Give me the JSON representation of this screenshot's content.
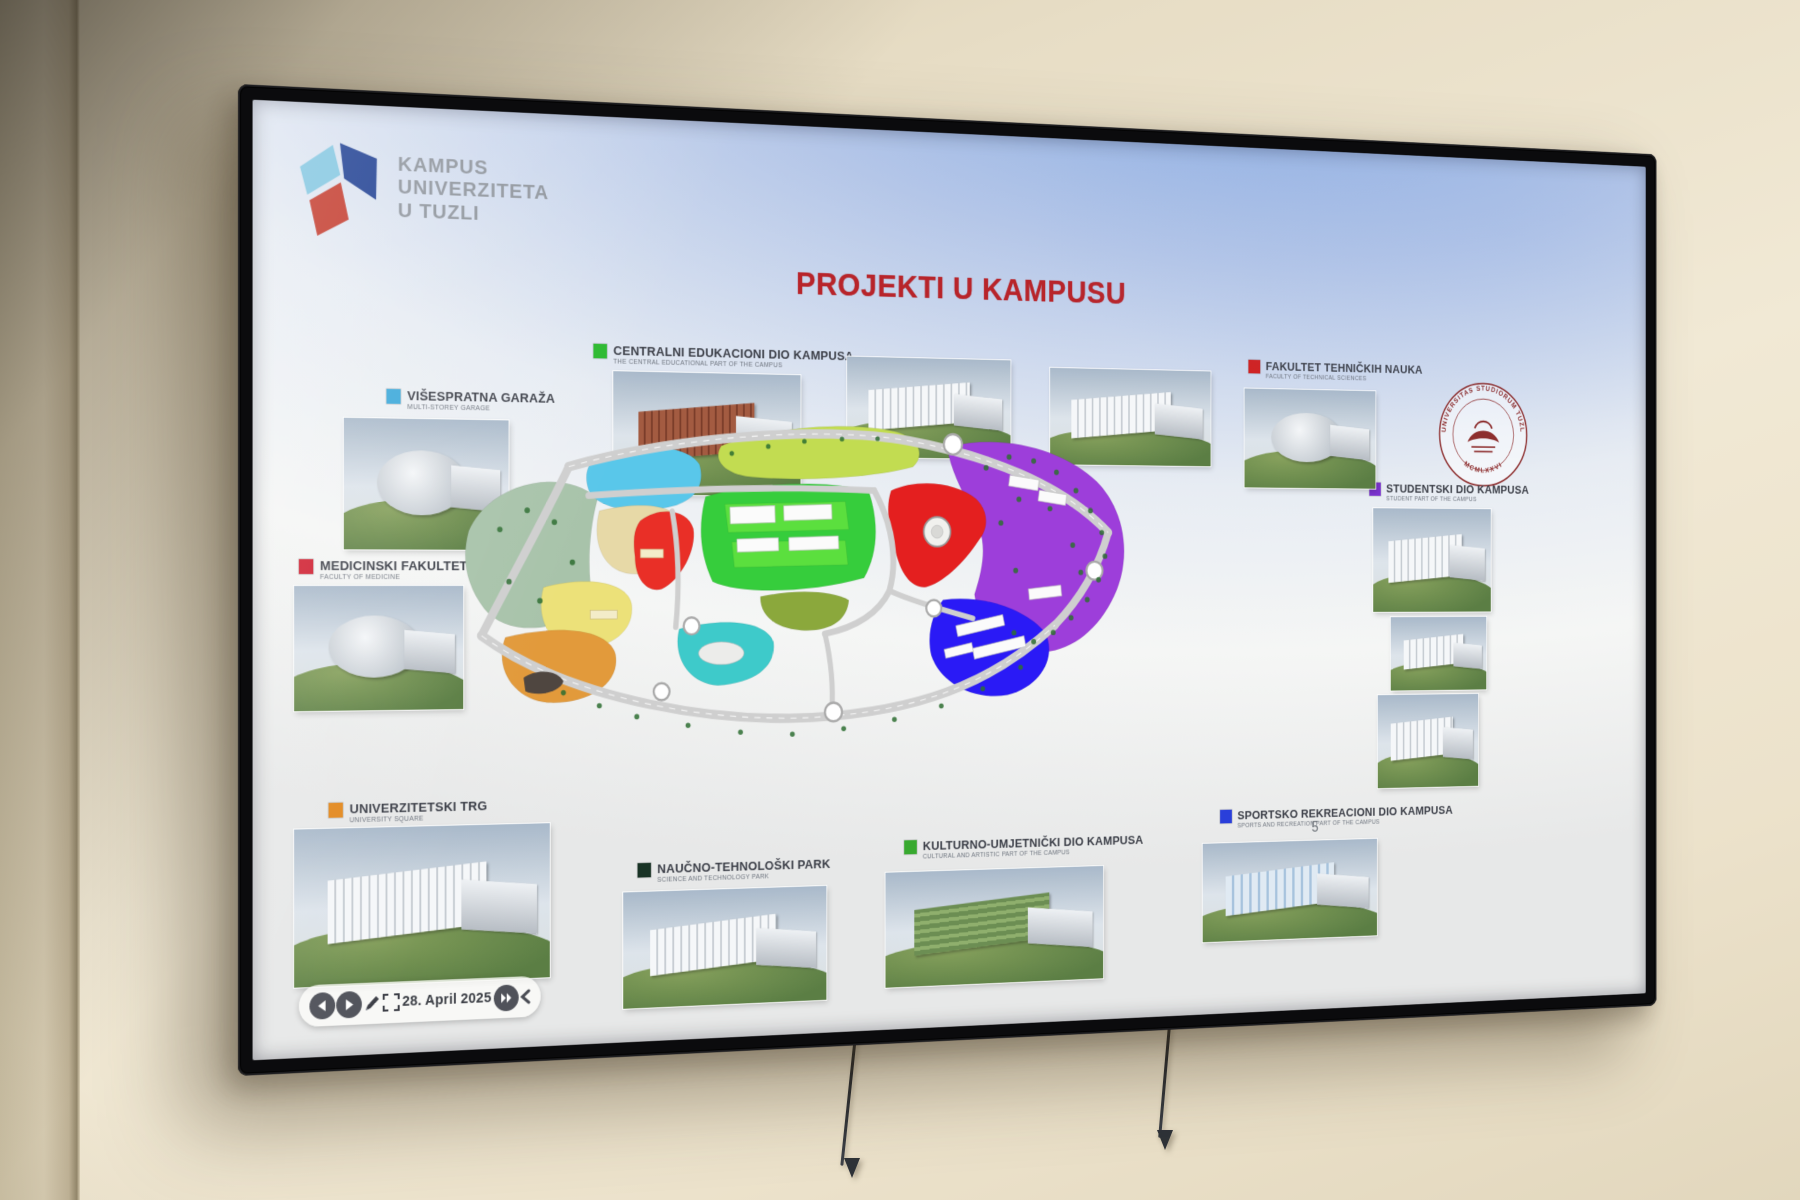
{
  "scene": {
    "wall_color": "#ece2cb",
    "tv_bezel_color": "#0b0b0d"
  },
  "slide": {
    "logo": {
      "lines": [
        "KAMPUS",
        "UNIVERZITETA",
        "U TUZLI"
      ],
      "cube_colors": {
        "top": "#84c6e0",
        "right": "#1d3d8f",
        "bottom": "#c03a2c"
      }
    },
    "title": {
      "text": "PROJEKTI U KAMPUSU",
      "color": "#b5252b"
    },
    "page_number": "5",
    "legend": [
      {
        "id": "garage",
        "label": "VIŠESPRATNA GARAŽA",
        "sublabel": "MULTI-STOREY GARAGE",
        "color": "#3fa8d8"
      },
      {
        "id": "central",
        "label": "CENTRALNI EDUKACIONI DIO KAMPUSA",
        "sublabel": "THE CENTRAL EDUCATIONAL PART OF THE CAMPUS",
        "color": "#2eb832"
      },
      {
        "id": "ftn",
        "label": "FAKULTET TEHNIČKIH NAUKA",
        "sublabel": "FACULTY OF TECHNICAL SCIENCES",
        "color": "#cc2222"
      },
      {
        "id": "student",
        "label": "STUDENTSKI DIO KAMPUSA",
        "sublabel": "STUDENT PART OF THE CAMPUS",
        "color": "#7b35cc"
      },
      {
        "id": "medical",
        "label": "MEDICINSKI FAKULTET",
        "sublabel": "FACULTY OF MEDICINE",
        "color": "#cc2233"
      },
      {
        "id": "square",
        "label": "UNIVERZITETSKI TRG",
        "sublabel": "UNIVERSITY SQUARE",
        "color": "#e08820"
      },
      {
        "id": "techpark",
        "label": "NAUČNO-TEHNOLOŠKI PARK",
        "sublabel": "SCIENCE AND TECHNOLOGY PARK",
        "color": "#1a3325"
      },
      {
        "id": "cultural",
        "label": "KULTURNO-UMJETNIČKI DIO KAMPUSA",
        "sublabel": "CULTURAL AND ARTISTIC PART OF THE CAMPUS",
        "color": "#3aa832"
      },
      {
        "id": "sports",
        "label": "SPORTSKO REKREACIONI DIO KAMPUSA",
        "sublabel": "SPORTS AND RECREATION PART OF THE CAMPUS",
        "color": "#2b3fd6"
      }
    ],
    "seal": {
      "ring_text": "UNIVERSITAS STUDIORUM TUZLAENSIS",
      "year_text": "MCMLXXVI",
      "color": "#8b2f2f"
    },
    "toolbar": {
      "date": "28. April 2025"
    },
    "map": {
      "zones": [
        {
          "name": "park",
          "color": "#a9c3ab"
        },
        {
          "name": "garage-cyan",
          "color": "#5cc6e8"
        },
        {
          "name": "botanical-cream",
          "color": "#e7d9a8"
        },
        {
          "name": "yellow-field",
          "color": "#ece17c"
        },
        {
          "name": "university-square",
          "color": "#e09a3e"
        },
        {
          "name": "top-green-strip",
          "color": "#c2dc55"
        },
        {
          "name": "central-education",
          "color": "#39cc3f"
        },
        {
          "name": "central-blocks",
          "color": "#5ede42"
        },
        {
          "name": "olive-zone",
          "color": "#8ba83f"
        },
        {
          "name": "cultural-teal",
          "color": "#41c9c9"
        },
        {
          "name": "medical-red",
          "color": "#e53028"
        },
        {
          "name": "technical-red",
          "color": "#df2020"
        },
        {
          "name": "student-purple",
          "color": "#9b3fd6"
        },
        {
          "name": "sports-blue",
          "color": "#2a1bf0"
        },
        {
          "name": "road",
          "color": "#cfcfcf"
        },
        {
          "name": "tree",
          "color": "#2f6e33"
        }
      ]
    }
  }
}
